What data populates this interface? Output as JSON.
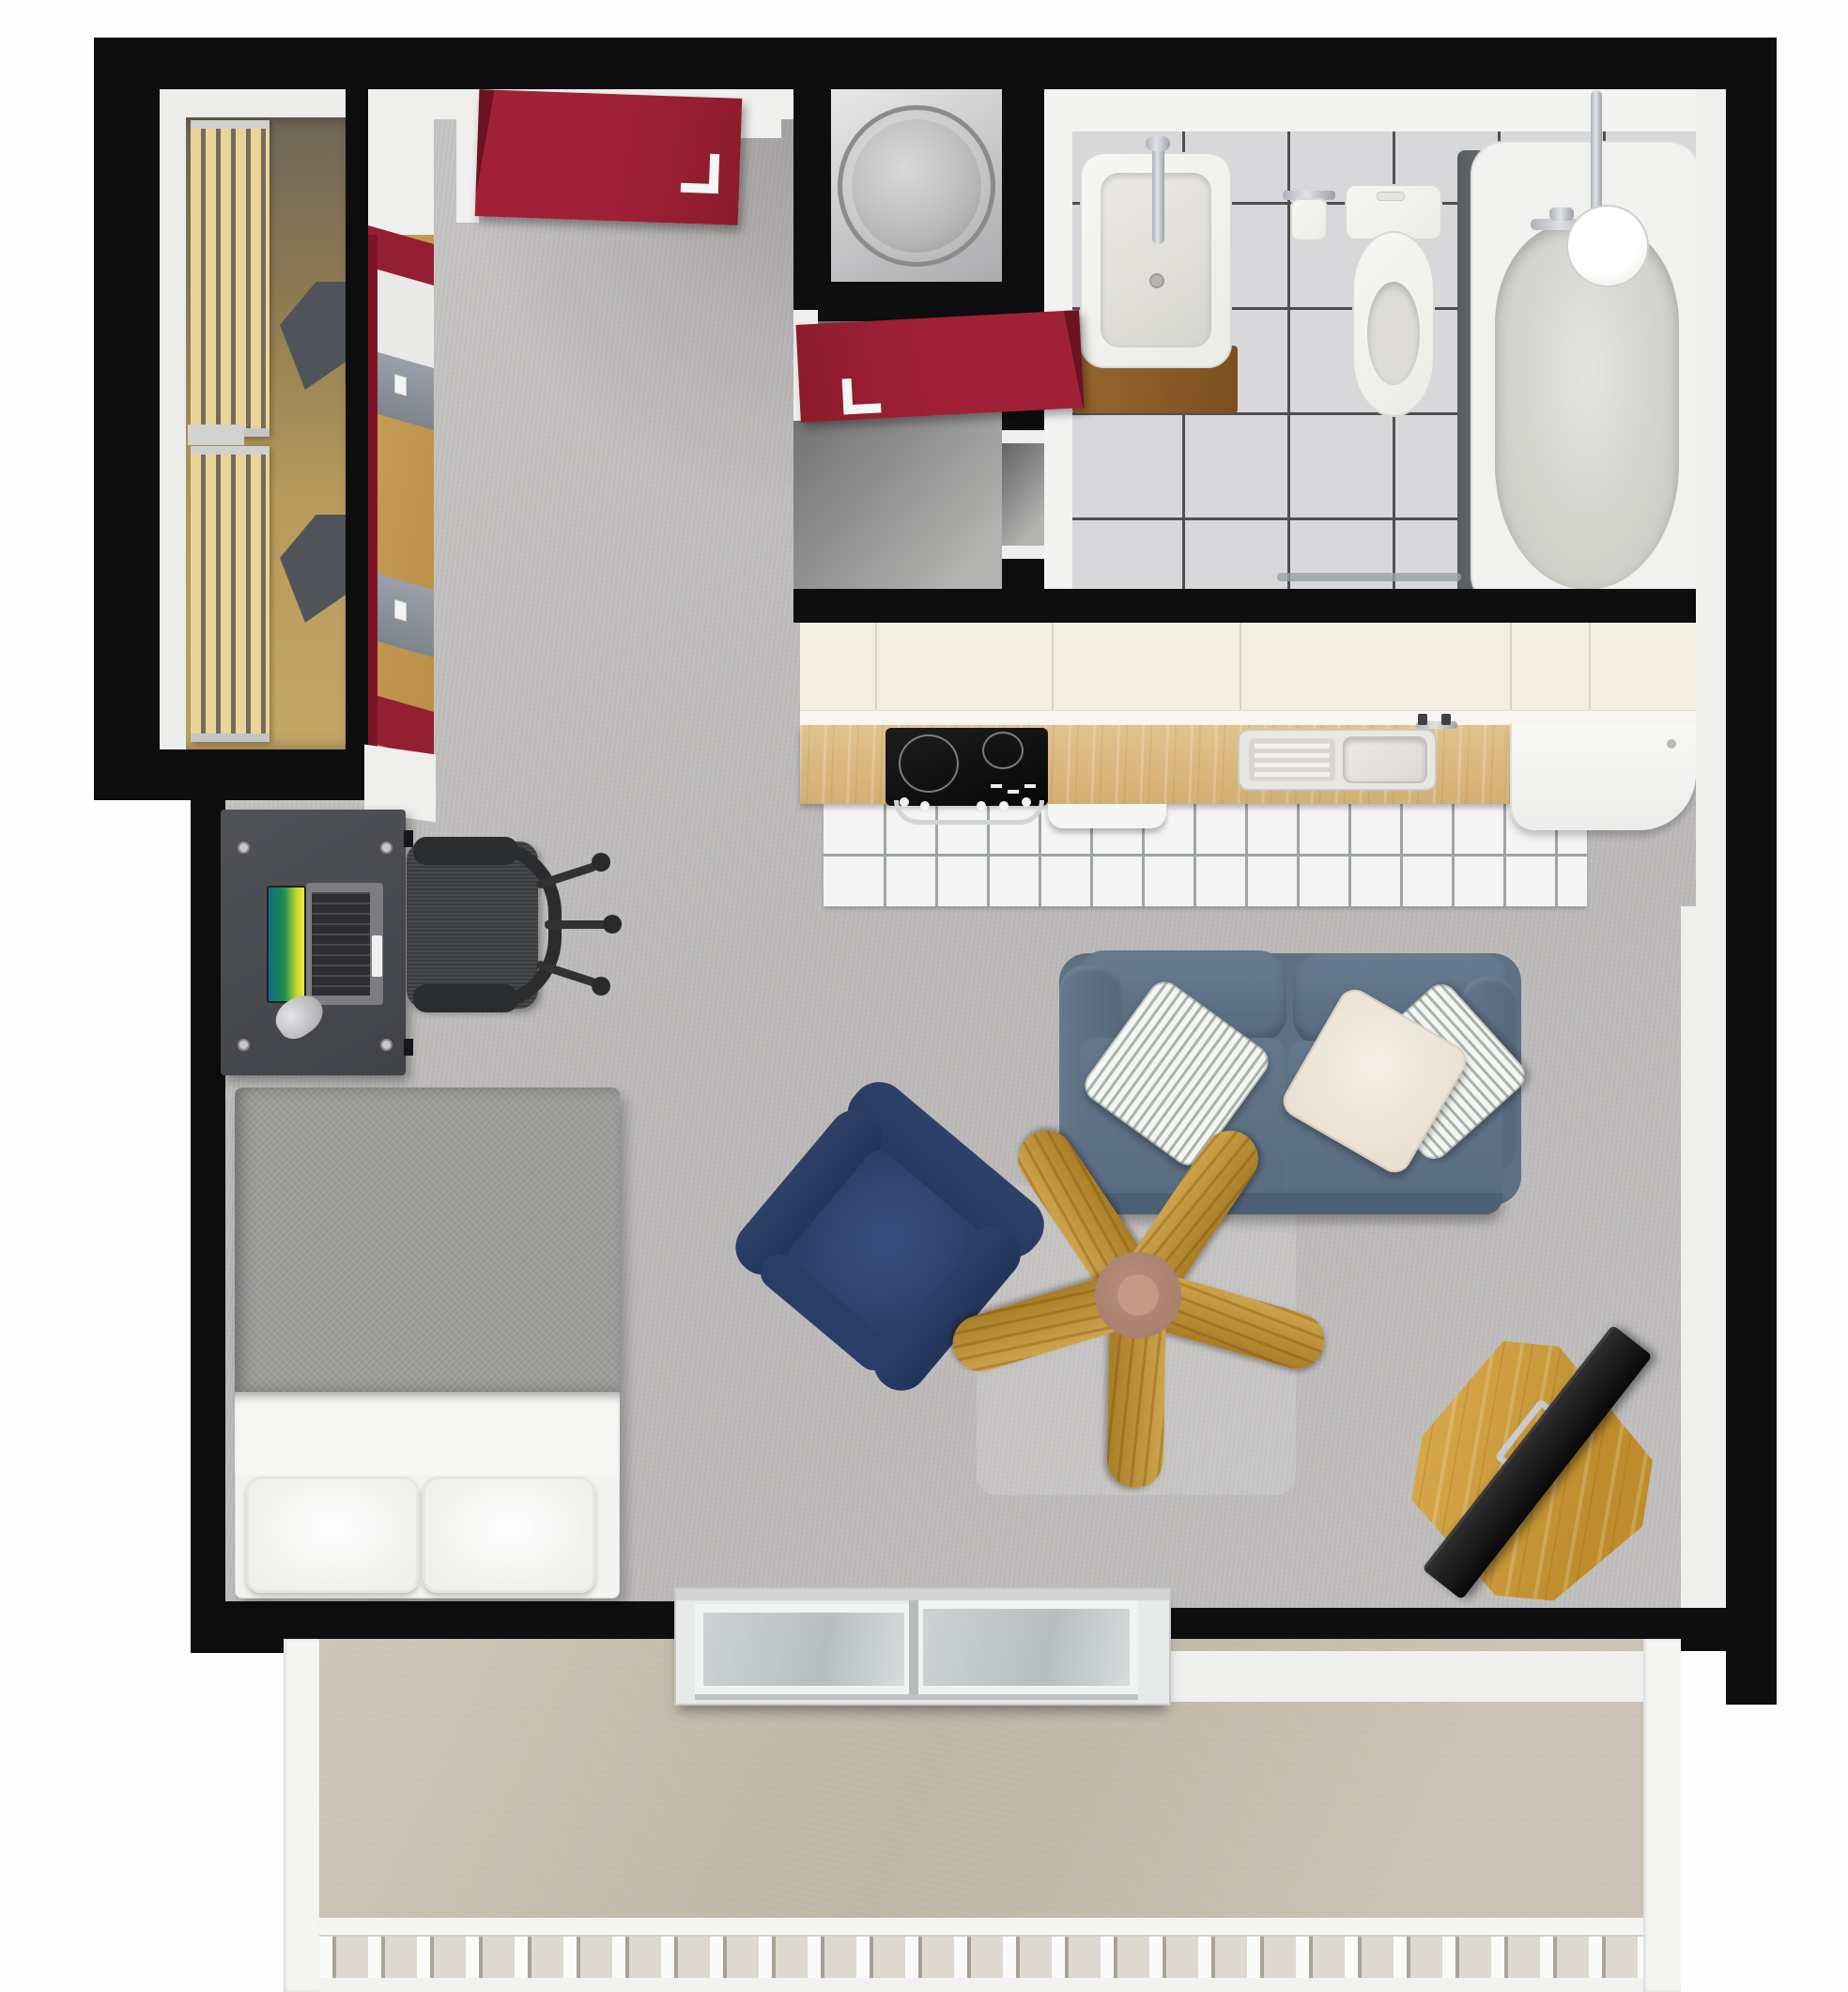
{
  "meta": {
    "title": "Studio apartment 3D floor plan (top-down view)",
    "view": "top-down 3D render",
    "canvas": "1968x2121"
  },
  "palette": {
    "wall": "#0e0e0e",
    "accent_red": "#941e32",
    "floor_main": "#c4c2c1",
    "closet_wood": "#b5944f",
    "bath_tile": "#d8d8db",
    "bath_grout": "#4f4f52",
    "kitchen_tile": "#f3f4f3",
    "cabinet_cream": "#f2eee1",
    "counter_wood": "#ddbd85",
    "sofa_blue": "#5d7084",
    "armchair_navy": "#2c3e66",
    "fan_wood": "#c2973b",
    "fan_hub": "#ad8574",
    "desk_gray": "#4b4d52",
    "bed_blanket": "#9b9b99",
    "balcony_concrete": "#c6beae",
    "chrome": "#c8cbcf",
    "tv_black": "#111111"
  },
  "rooms": [
    {
      "id": "closet",
      "label": "walk-in closet"
    },
    {
      "id": "hallway",
      "label": "entry hallway"
    },
    {
      "id": "utility",
      "label": "utility closet"
    },
    {
      "id": "bathroom",
      "label": "bathroom"
    },
    {
      "id": "kitchen",
      "label": "kitchen"
    },
    {
      "id": "living",
      "label": "living and sleeping area"
    },
    {
      "id": "balcony",
      "label": "balcony"
    }
  ],
  "furniture": [
    {
      "id": "slat-rack-upper",
      "label": "closet slatted rack (upper)"
    },
    {
      "id": "slat-rack-lower",
      "label": "closet slatted rack (lower)"
    },
    {
      "id": "closet-shelf-a",
      "label": "closet corner shelf"
    },
    {
      "id": "closet-shelf-b",
      "label": "closet corner shelf"
    },
    {
      "id": "red-wall-unit",
      "label": "red framed wall shelf unit"
    },
    {
      "id": "door-main",
      "label": "red room door (open)"
    },
    {
      "id": "door-entry",
      "label": "red entry door (open)"
    },
    {
      "id": "water-heater",
      "label": "round water heater"
    },
    {
      "id": "bath-sink",
      "label": "bathroom sink"
    },
    {
      "id": "sink-vanity",
      "label": "wooden sink vanity"
    },
    {
      "id": "toilet",
      "label": "toilet"
    },
    {
      "id": "tp-holder",
      "label": "toilet paper holder"
    },
    {
      "id": "bathtub",
      "label": "bathtub"
    },
    {
      "id": "shower",
      "label": "shower fixture"
    },
    {
      "id": "upper-cabinets",
      "label": "kitchen upper cabinets"
    },
    {
      "id": "countertop",
      "label": "kitchen countertop"
    },
    {
      "id": "cooktop",
      "label": "cooktop and oven"
    },
    {
      "id": "dishwasher",
      "label": "dishwasher front"
    },
    {
      "id": "kitchen-sink",
      "label": "kitchen sink with drainboard"
    },
    {
      "id": "washing-machine",
      "label": "white appliance"
    },
    {
      "id": "kitchen-tiles",
      "label": "kitchen floor tiles"
    },
    {
      "id": "desk",
      "label": "desk"
    },
    {
      "id": "laptop",
      "label": "laptop"
    },
    {
      "id": "figurine",
      "label": "silver desk object"
    },
    {
      "id": "office-chair",
      "label": "office chair"
    },
    {
      "id": "bed",
      "label": "bed"
    },
    {
      "id": "pillow-left",
      "label": "bed pillow left"
    },
    {
      "id": "pillow-right",
      "label": "bed pillow right"
    },
    {
      "id": "sofa",
      "label": "blue loveseat sofa"
    },
    {
      "id": "cushion-striped-l",
      "label": "striped cushion left"
    },
    {
      "id": "cushion-cream",
      "label": "cream cushion"
    },
    {
      "id": "cushion-striped-r",
      "label": "striped cushion right"
    },
    {
      "id": "armchair",
      "label": "navy armchair"
    },
    {
      "id": "ceiling-fan",
      "label": "wooden ceiling fan"
    },
    {
      "id": "tv",
      "label": "flat screen tv"
    },
    {
      "id": "tv-table",
      "label": "wooden tv table"
    },
    {
      "id": "sliding-door",
      "label": "balcony sliding door"
    },
    {
      "id": "railing",
      "label": "balcony railing"
    }
  ]
}
